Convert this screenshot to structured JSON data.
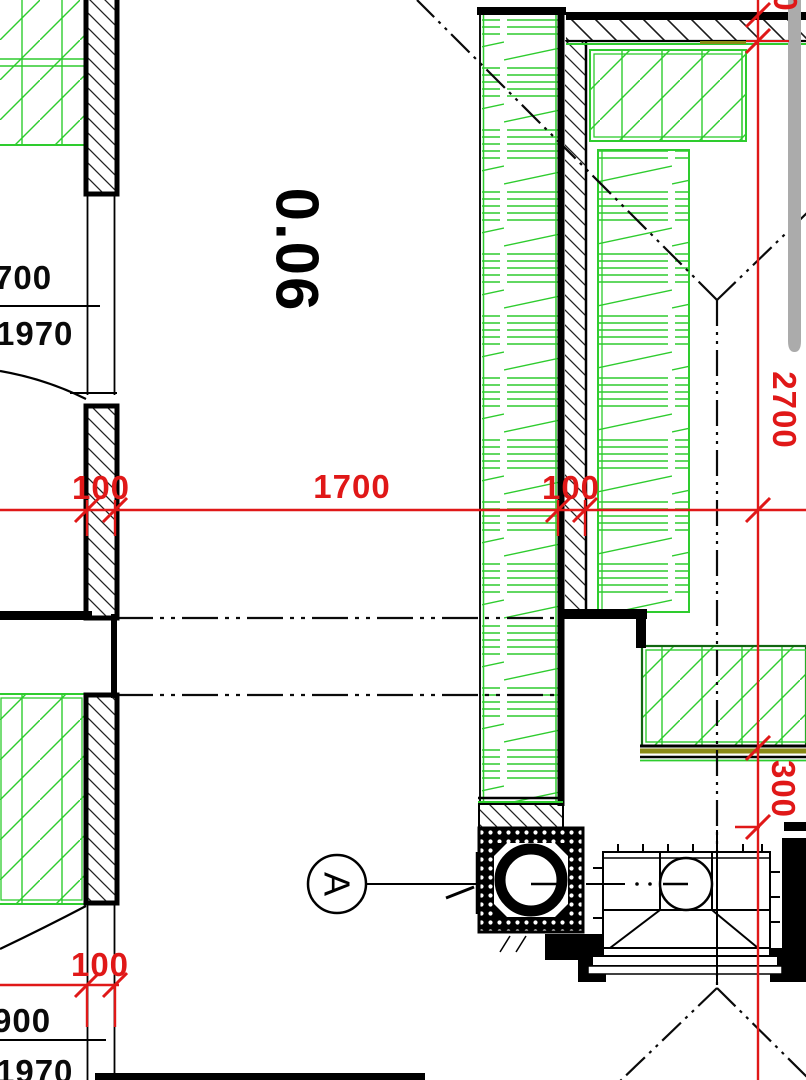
{
  "drawing_type": "architectural-floor-plan-detail",
  "room": {
    "number": "0.06"
  },
  "section_marker": {
    "letter": "A"
  },
  "dimensions": {
    "red": {
      "left_wall_thickness": "100",
      "opening_span": "1700",
      "mid_wall_thickness": "100",
      "right_vertical_span": "2700",
      "right_offset": "300",
      "bottom_wall_thickness": "100",
      "top_partial_digit": "0"
    },
    "black": {
      "door_top_width": "700",
      "door_top_height": "1970",
      "door_bottom_width": "900",
      "door_bottom_height": "1970"
    }
  },
  "colors": {
    "dimension_red": "#e01818",
    "insulation_green": "#2ecc2e",
    "wall_black": "#000000",
    "shaft_gray": "#ababab",
    "accent_olive": "#8a8a15"
  }
}
